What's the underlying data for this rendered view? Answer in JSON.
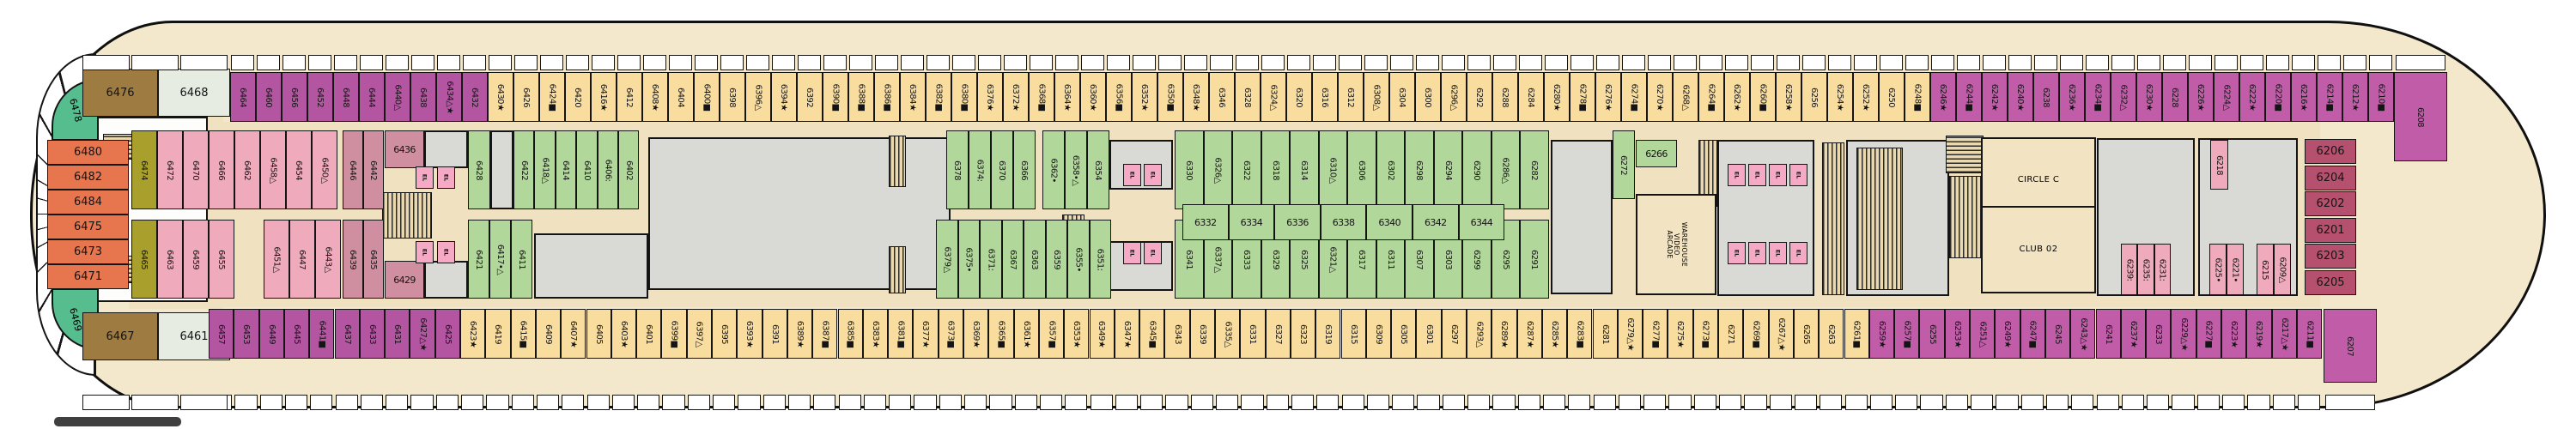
{
  "title": "Deck 6 cruise ship deck plan",
  "colors": {
    "magentaA": "#b455a2",
    "magentaB": "#c05ca8",
    "yellow": "#f9dd9f",
    "pink": "#efaabc",
    "rose": "#d08fa0",
    "olive": "#a89f2c",
    "green": "#b2d79b",
    "wedge": "#55bd8e",
    "brown": "#9d7b41",
    "pale": "#e6ece2",
    "orange": "#e7764f",
    "bowrose": "#b5516f",
    "elpink": "#f6a9c5",
    "tan": "#f0e2c0",
    "gray": "#d9dad6"
  },
  "rows": {
    "top": {
      "segments": [
        {
          "color": "magentaA",
          "cabins": [
            "6464",
            "6460",
            "6456",
            "6452",
            "6448",
            "6444",
            "6440△",
            "6438",
            "6434△★",
            "6432"
          ]
        },
        {
          "color": "yellow",
          "cabins": [
            "6430★",
            "6426",
            "6424■",
            "6420",
            "6416★",
            "6412",
            "6408★",
            "6404",
            "6400■",
            "6398",
            "6396△",
            "6394★",
            "6392",
            "6390■",
            "6388■",
            "6386■",
            "6384★",
            "6382■",
            "6380■",
            "6376★",
            "6372★",
            "6368■",
            "6364★",
            "6360★",
            "6356■",
            "6352★",
            "6350■",
            "6348★",
            "6346",
            "6328",
            "6324△",
            "6320",
            "6316",
            "6312",
            "6308△",
            "6304",
            "6300",
            "6296△",
            "6292",
            "6288",
            "6284",
            "6280★",
            "6278■",
            "6276★",
            "6274■",
            "6270★",
            "6268△",
            "6264■",
            "6262★",
            "6260■",
            "6258★",
            "6256",
            "6254★",
            "6252★",
            "6250",
            "6248■"
          ]
        },
        {
          "color": "magentaB",
          "cabins": [
            "6246★",
            "6244■",
            "6242★",
            "6240★",
            "6238",
            "6236★",
            "6234■",
            "6232△",
            "6230★",
            "6228",
            "6226★",
            "6224△",
            "6222★",
            "6220■",
            "6216★",
            "6214■",
            "6212★",
            "6210■"
          ]
        }
      ],
      "corner": "6208"
    },
    "bottom": {
      "segments": [
        {
          "color": "magentaA",
          "cabins": [
            "6457",
            "6453",
            "6449",
            "6445",
            "6441■",
            "6437",
            "6433",
            "6431",
            "6427△★",
            "6425"
          ]
        },
        {
          "color": "yellow",
          "cabins": [
            "6423★",
            "6419",
            "6415■",
            "6409",
            "6407★",
            "6405",
            "6403★",
            "6401",
            "6399■",
            "6397△",
            "6395",
            "6393★",
            "6391",
            "6389★",
            "6387■",
            "6385■",
            "6383★",
            "6381■",
            "6377★",
            "6373■",
            "6369★",
            "6365■",
            "6361★",
            "6357■",
            "6353★",
            "6349★",
            "6347★",
            "6345■",
            "6343",
            "6339",
            "6335△",
            "6331",
            "6327",
            "6323",
            "6319",
            "6315",
            "6309",
            "6305",
            "6301",
            "6297",
            "6293△",
            "6289★",
            "6287★",
            "6285★",
            "6283■",
            "6281",
            "6279△★",
            "6277■",
            "6275★",
            "6273■",
            "6271",
            "6269■",
            "6267△★",
            "6265",
            "6263",
            "6261■"
          ]
        },
        {
          "color": "magentaB",
          "cabins": [
            "6259★",
            "6257■",
            "6255",
            "6253★",
            "6251△",
            "6249★",
            "6247■",
            "6245",
            "6243△★",
            "6241",
            "6237★",
            "6233",
            "6229△★",
            "6227■",
            "6223★",
            "6219★",
            "6217△★",
            "6211■"
          ]
        }
      ],
      "corner": "6207"
    }
  },
  "stern": {
    "wedge_top": "6478",
    "wedge_bottom": "6469",
    "top_suites": [
      {
        "label": "6476",
        "color": "brown"
      },
      {
        "label": "6468",
        "color": "pale"
      }
    ],
    "bottom_suites": [
      {
        "label": "6467",
        "color": "brown"
      },
      {
        "label": "6461",
        "color": "pale"
      }
    ],
    "aft_cabins": [
      "6480",
      "6482",
      "6484",
      "6475",
      "6473",
      "6471"
    ]
  },
  "bow": {
    "stack": [
      "6206",
      "6204",
      "6202",
      "6201",
      "6203",
      "6205"
    ]
  },
  "clusters": [
    {
      "id": "r2a",
      "color": "pink",
      "cells": [
        {
          "t": "6474",
          "c": "olive"
        },
        "6472",
        "6470",
        "6466",
        "6462",
        "6458△",
        "6454",
        "6450△"
      ]
    },
    {
      "id": "r2b",
      "color": "rose",
      "cells": [
        "6446",
        "6442"
      ]
    },
    {
      "id": "r2c",
      "color": "rose",
      "horiz": true,
      "cells": [
        "6436"
      ]
    },
    {
      "id": "r3a",
      "color": "pink",
      "cells": [
        {
          "t": "6465",
          "c": "olive"
        },
        "6463",
        "6459",
        "6455"
      ]
    },
    {
      "id": "r3b",
      "color": "pink",
      "cells": [
        "6451△",
        "6447",
        "6443△"
      ]
    },
    {
      "id": "r3c",
      "color": "rose",
      "cells": [
        "6439",
        "6435"
      ]
    },
    {
      "id": "r3d",
      "color": "rose",
      "horiz": true,
      "cells": [
        "6429"
      ]
    },
    {
      "id": "r2d",
      "color": "green",
      "cells": [
        "6428"
      ]
    },
    {
      "id": "r2e",
      "color": "green",
      "cells": [
        "6422",
        "6418△",
        "6414",
        "6410",
        "6406:",
        "6402"
      ]
    },
    {
      "id": "r3e",
      "color": "green",
      "cells": [
        "6421",
        "6417•△",
        "6411"
      ]
    },
    {
      "id": "r2f",
      "color": "green",
      "cells": [
        "6378",
        "6374:",
        "6370",
        "6366"
      ]
    },
    {
      "id": "r2g",
      "color": "green",
      "cells": [
        "6362•",
        "6358•△",
        "6354"
      ]
    },
    {
      "id": "r3f",
      "color": "green",
      "cells": [
        "6379△",
        "6375•",
        "6371:",
        "6367",
        "6363",
        "6359",
        "6355•",
        "6351:"
      ]
    },
    {
      "id": "r2h",
      "color": "green",
      "cells": [
        "6330",
        "6326△",
        "6322",
        "6318",
        "6314",
        "6310△",
        "6306",
        "6302",
        "6298",
        "6294",
        "6290",
        "6286△",
        "6282"
      ]
    },
    {
      "id": "r3g",
      "color": "green",
      "cells": [
        "6341",
        "6337△",
        "6333",
        "6329",
        "6325",
        "6321△",
        "6317",
        "6311",
        "6307",
        "6303",
        "6299",
        "6295",
        "6291"
      ]
    },
    {
      "id": "mid",
      "color": "green",
      "horiz": true,
      "cells": [
        "6332",
        "6334",
        "6336",
        "6338",
        "6340",
        "6342",
        "6344"
      ]
    },
    {
      "id": "r2i",
      "color": "green",
      "cells": [
        "6272"
      ]
    },
    {
      "id": "r2j",
      "color": "green",
      "horiz": true,
      "cells": [
        "6266"
      ]
    },
    {
      "id": "p1",
      "color": "pink",
      "cells": [
        "6239:",
        "6235:",
        "6231:"
      ]
    },
    {
      "id": "p2",
      "color": "pink",
      "cells": [
        "6218"
      ]
    },
    {
      "id": "p3",
      "color": "pink",
      "cells": [
        "6225•",
        "6221•"
      ]
    },
    {
      "id": "p4",
      "color": "pink",
      "cells": [
        "6215",
        "6209△"
      ]
    }
  ],
  "rooms": [
    {
      "id": "circlec",
      "label": "CIRCLE C"
    },
    {
      "id": "club02",
      "label": "CLUB 02"
    },
    {
      "id": "arcade",
      "label": "WAREHOUSE\nVIDEO\nARCADE",
      "rotated": true
    }
  ],
  "elevator_label": "EL"
}
